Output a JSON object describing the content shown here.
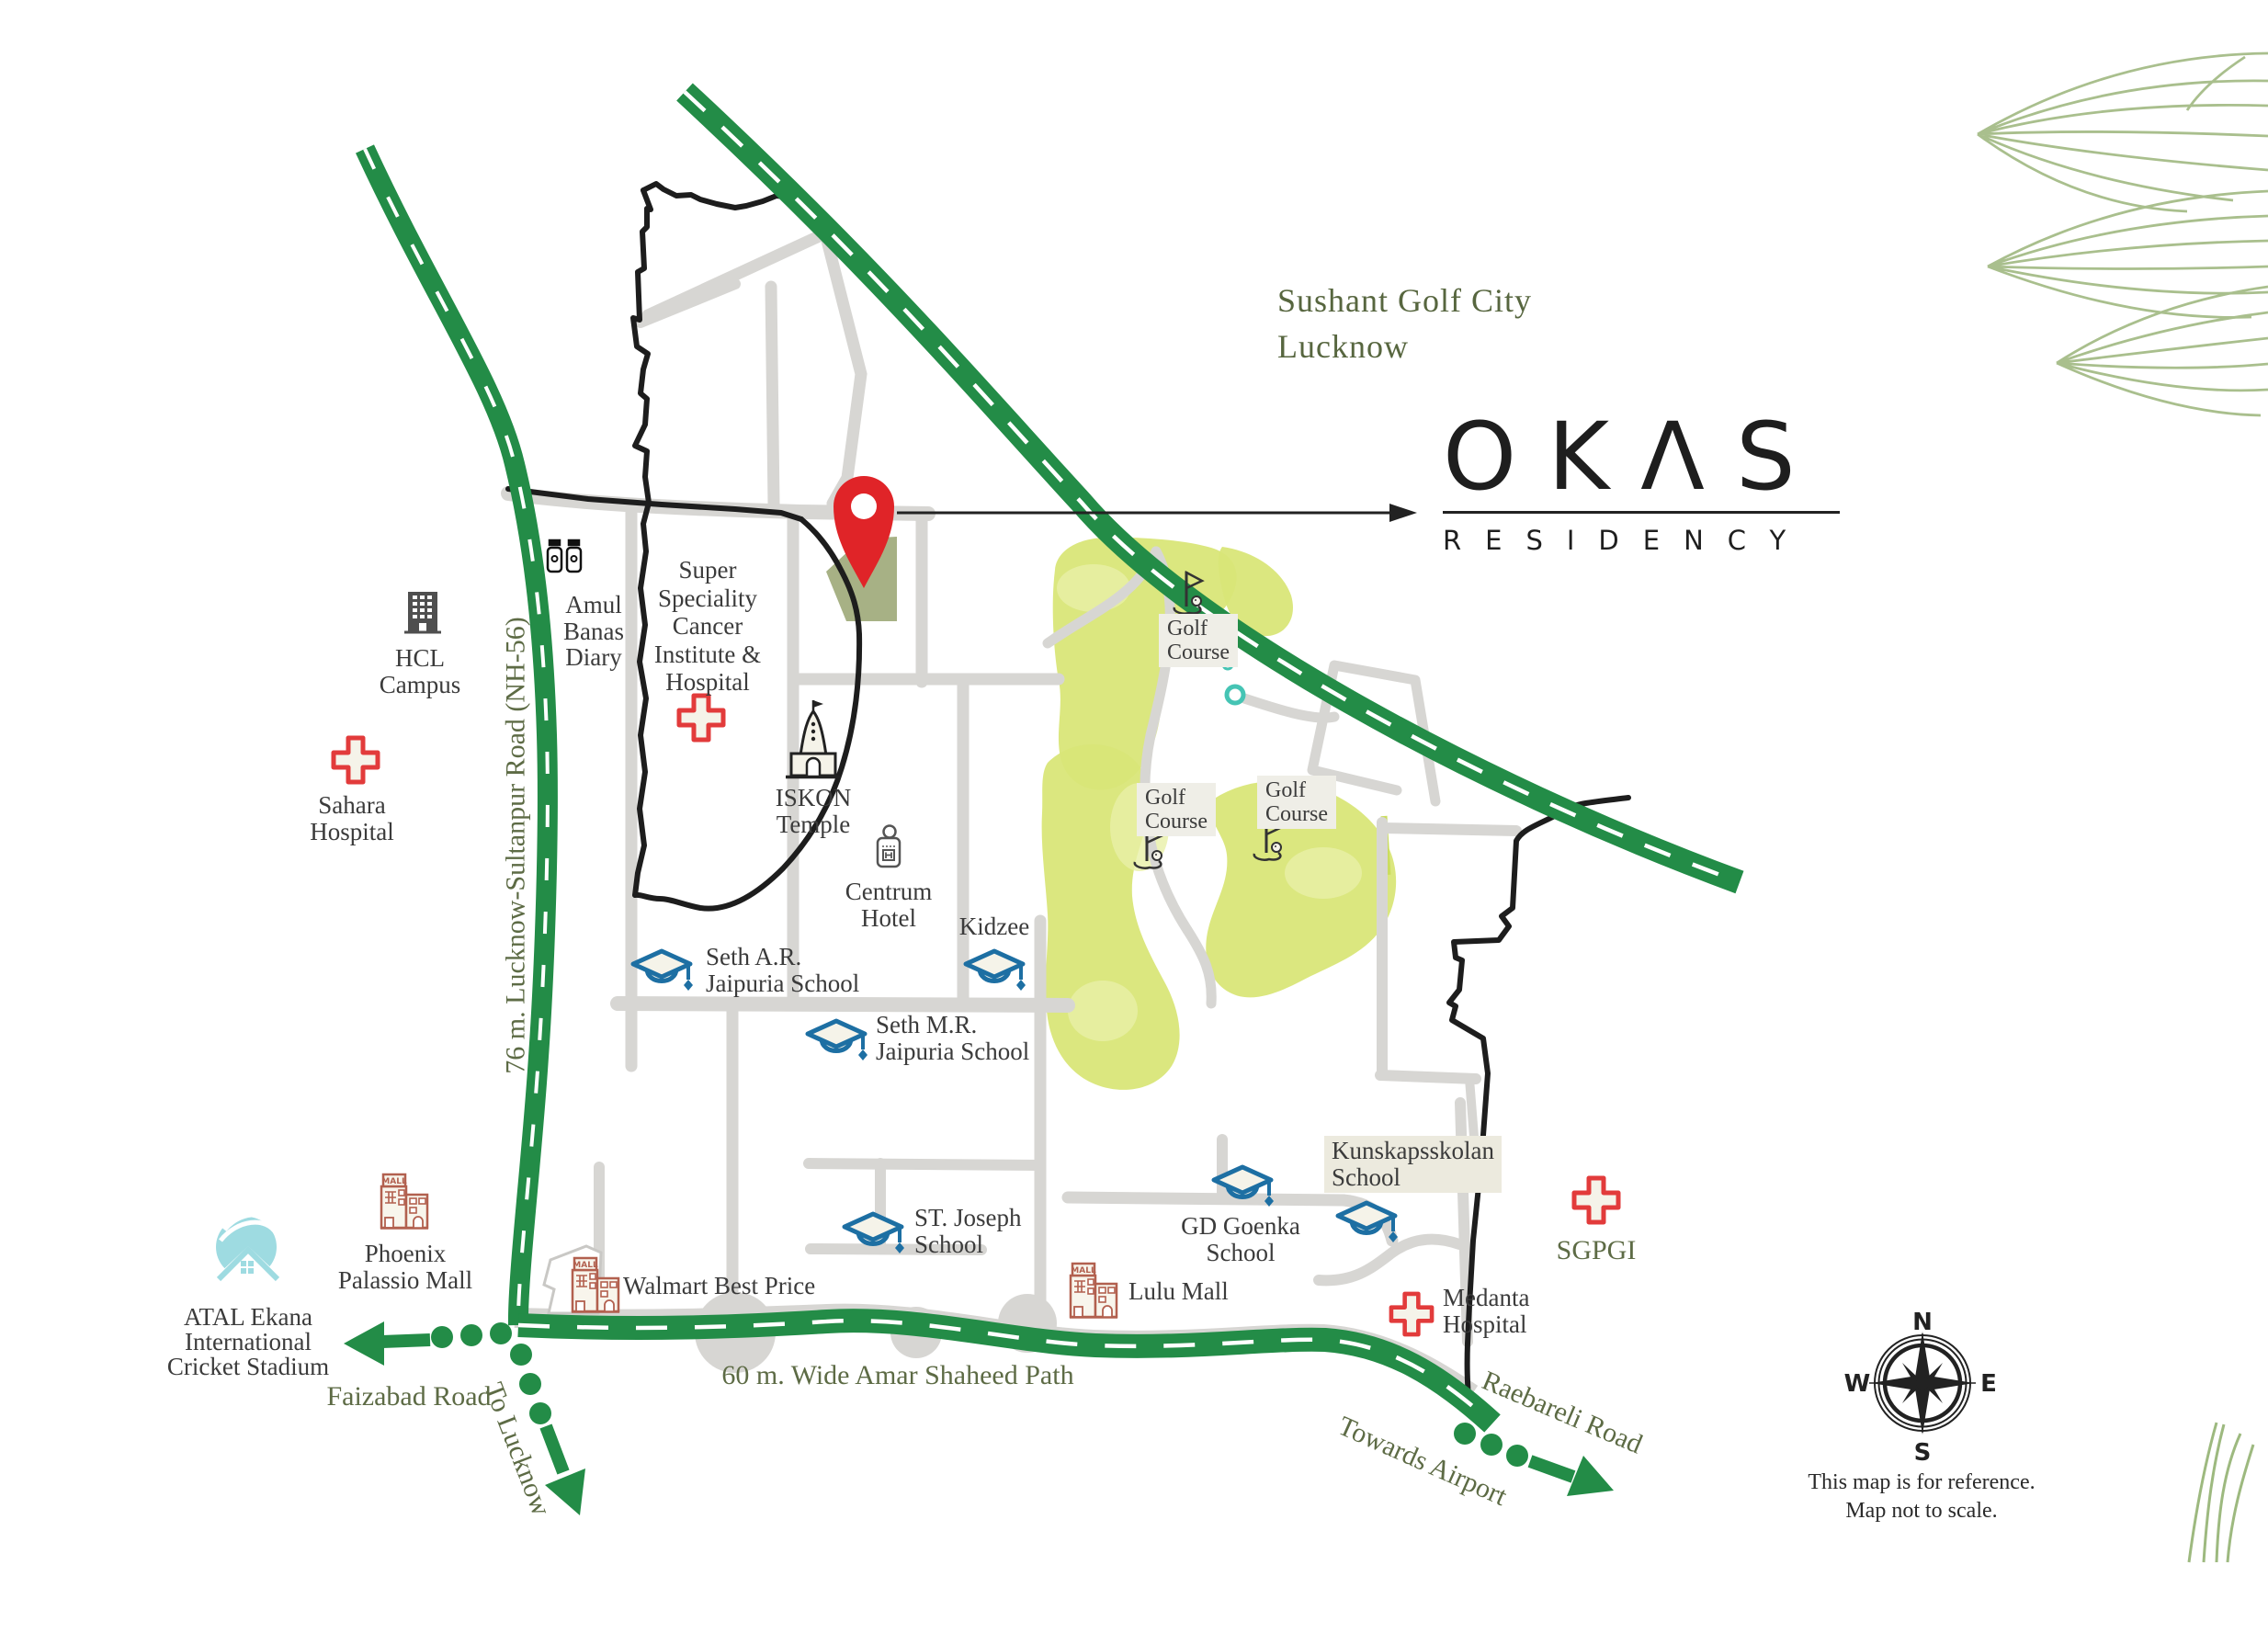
{
  "title": {
    "line1": "Sushant Golf City",
    "line2": "Lucknow"
  },
  "brand": {
    "name": "OKΛS",
    "sub": "RESIDENCY"
  },
  "landmarks": {
    "hcl": [
      "HCL",
      "Campus"
    ],
    "sahara": [
      "Sahara",
      "Hospital"
    ],
    "amul": [
      "Amul",
      "Banas",
      "Diary"
    ],
    "super_speciality": [
      "Super",
      "Speciality",
      "Cancer",
      "Institute &",
      "Hospital"
    ],
    "iskon": [
      "ISKON",
      "Temple"
    ],
    "centrum": [
      "Centrum",
      "Hotel"
    ],
    "kidzee": [
      "Kidzee"
    ],
    "seth_ar": [
      "Seth A.R.",
      "Jaipuria School"
    ],
    "seth_mr": [
      "Seth M.R.",
      "Jaipuria School"
    ],
    "st_joseph": [
      "ST. Joseph",
      "School"
    ],
    "gd_goenka": [
      "GD Goenka",
      "School"
    ],
    "kunskapsskolan": [
      "Kunskapsskolan",
      "School"
    ],
    "medanta": [
      "Medanta",
      "Hospital"
    ],
    "sgpgi": "SGPGI",
    "walmart": "Walmart Best Price",
    "lulu": "Lulu Mall",
    "phoenix": [
      "Phoenix",
      "Palassio Mall"
    ],
    "atal": [
      "ATAL Ekana",
      "International",
      "Cricket Stadium"
    ],
    "golf_course": [
      "Golf",
      "Course"
    ]
  },
  "roads": {
    "nh56": "76 m. Lucknow-Sultanpur Road (NH-56)",
    "faizabad": "Faizabad Road",
    "to_lucknow": "To Lucknow",
    "amar_shaheed": "60 m. Wide Amar Shaheed Path",
    "raebareli": "Raebareli Road",
    "towards_airport": "Towards Airport"
  },
  "compass": {
    "n": "N",
    "e": "E",
    "s": "S",
    "w": "W"
  },
  "disclaimer": [
    "This map is for reference.",
    "Map not to scale."
  ],
  "mall_sign": "MALL",
  "icons": {
    "location-pin": "red map pin marking OKAS Residency plot",
    "graduation-cap": "blue school marker",
    "red-cross": "hospital marker",
    "mall-building": "shopping mall marker",
    "golf-flag": "golf course marker",
    "temple": "ISKON temple marker",
    "door-hanger": "hotel marker",
    "milk-bottles": "Amul dairy marker",
    "office-building": "HCL campus marker",
    "stadium": "cricket stadium marker",
    "compass-rose": "map orientation",
    "leaves": "decorative foliage"
  },
  "colors": {
    "highway_green": "#238c47",
    "road_gray": "#d7d6d3",
    "boundary_black": "#1d1d1d",
    "olive_text": "#5d6b45",
    "label_text": "#3b3b3b",
    "school_blue": "#1d6fa3",
    "hospital_red": "#e23b3b",
    "mall_brown": "#b2604f",
    "pin_red": "#e02428",
    "golf_lime": "#d9e678",
    "plot_sage": "#a7b185",
    "stadium_teal": "#9edbe1",
    "leaf_sage": "#a9bf8d"
  }
}
